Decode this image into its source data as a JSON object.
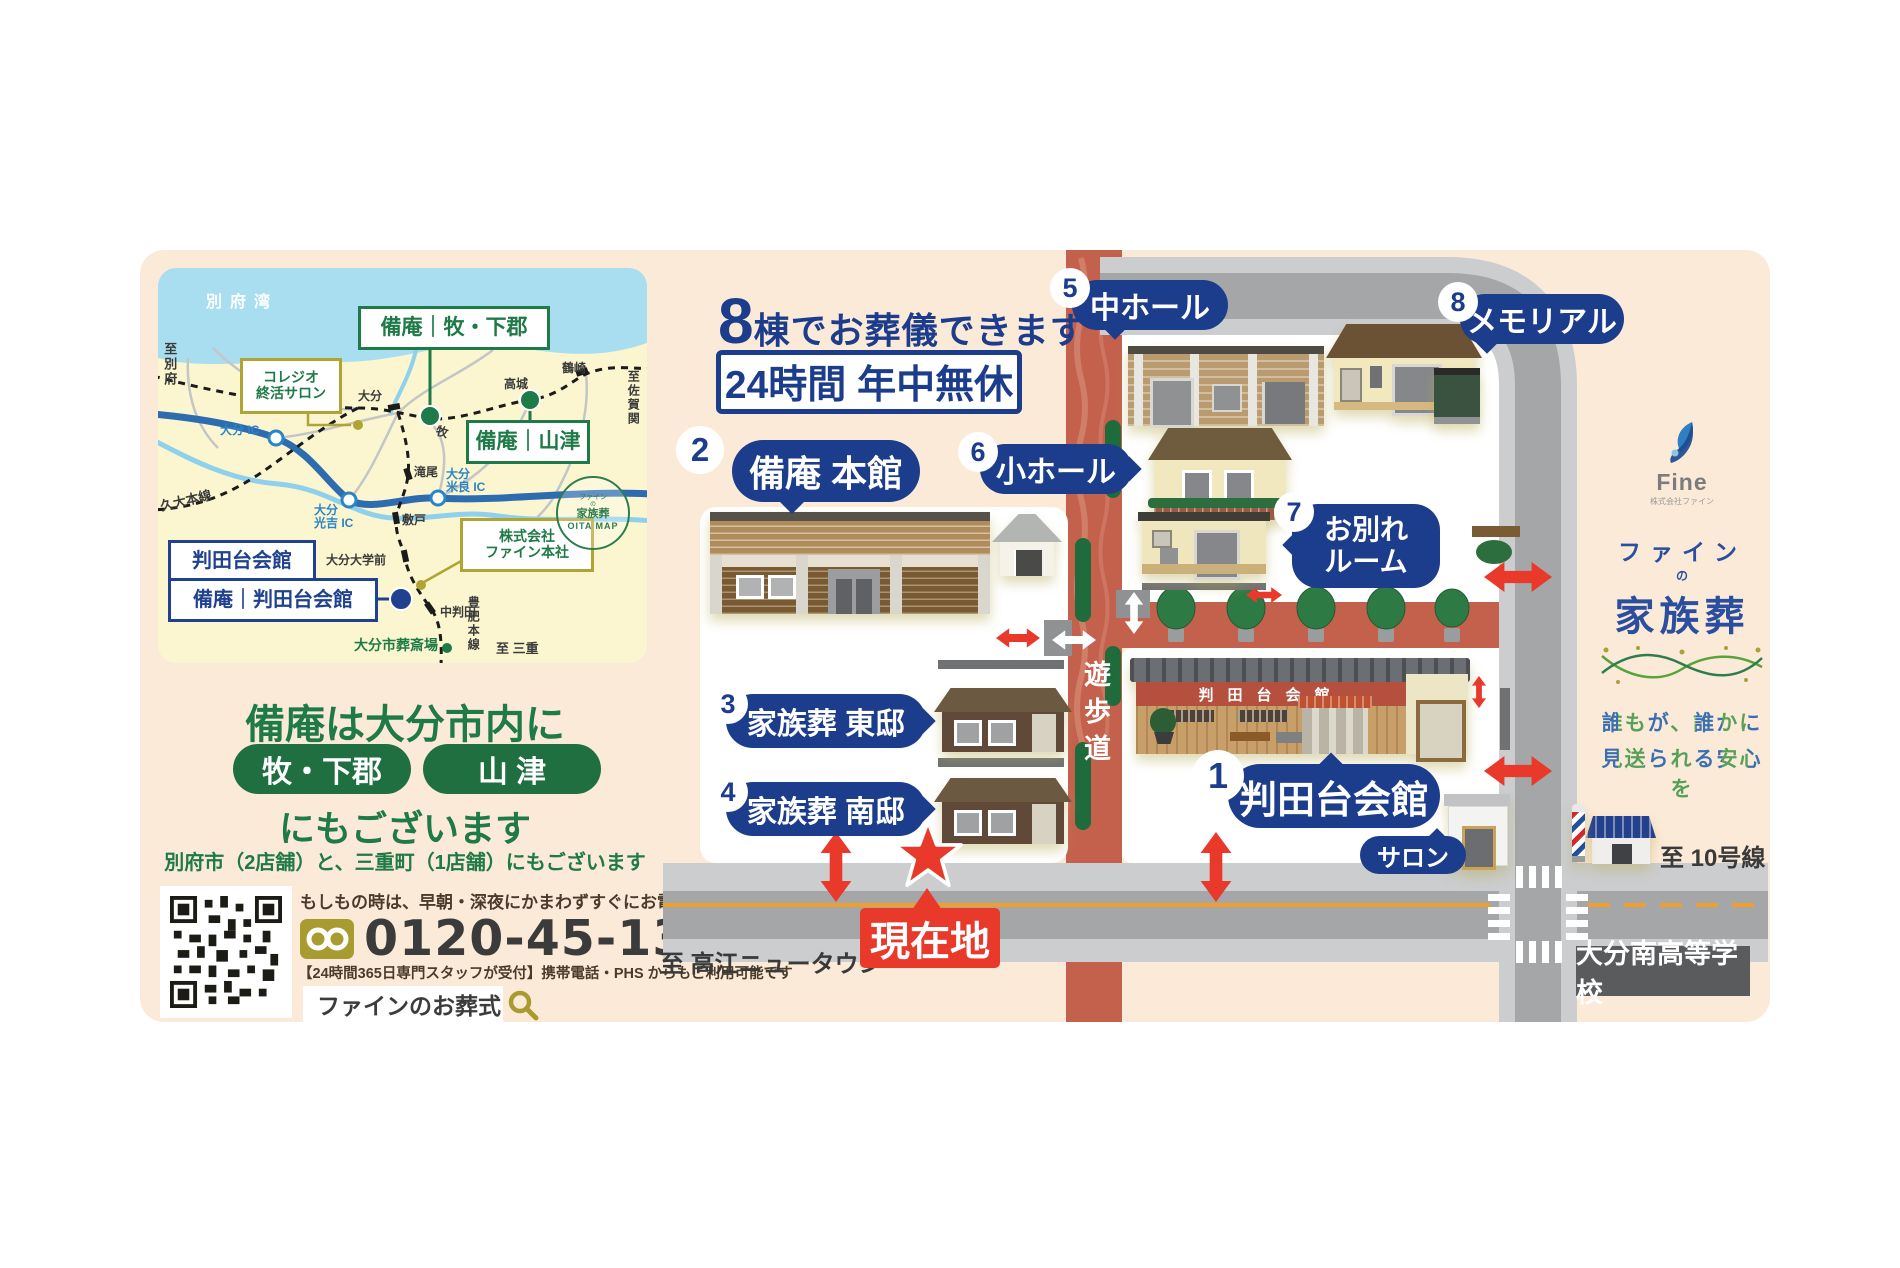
{
  "mini_map": {
    "sea": "別府湾",
    "to_beppu": "至別府",
    "to_saganoseki": "至佐賀関",
    "to_mie": "至 三重",
    "kudai_line": "久大本線",
    "hohi_line": "豊肥本線",
    "crematory": "大分市葬斎場",
    "stations": {
      "oita": "大分",
      "maki": "牧",
      "takajo": "高城",
      "tsurusaki": "鶴崎",
      "takio": "滝尾",
      "shikido": "敷戸",
      "daigakumae": "大分大学前",
      "nakahanda": "中判田"
    },
    "ics": {
      "oita": "大分 IC",
      "mitsuyoshi_1": "大分",
      "mitsuyoshi_2": "光吉 IC",
      "mera_1": "大分",
      "mera_2": "米良 IC"
    },
    "boxes": {
      "collegio_1": "コレジオ",
      "collegio_2": "終活サロン",
      "maki_shimogori": "備庵｜牧・下郡",
      "yamazu": "備庵｜山津",
      "fine_hq_1": "株式会社",
      "fine_hq_2": "ファイン本社",
      "handadai": "判田台会館",
      "bian_handadai": "備庵｜判田台会館"
    },
    "badge_logo_1": "ファイン",
    "badge_logo_2": "の",
    "badge_logo_3": "家族葬",
    "badge_text": "OITA MAP"
  },
  "left_info": {
    "headline1": "備庵は大分市内に",
    "pill1": "牧・下郡",
    "pill2": "山 津",
    "headline2": "にもございます",
    "note": "別府市（2店舗）と、三重町（1店舗）にもございます",
    "call_note": "もしもの時は、早朝・深夜にかまわずすぐにお電話下さい",
    "phone": "0120-45-1357",
    "phone_sub": "【24時間365日専門スタッフが受付】携帯電話・PHS からもご利用可能です",
    "search_text": "ファインのお葬式"
  },
  "main_map": {
    "headline_num": "8",
    "headline_text": "棟でお葬儀できます",
    "hours": "24時間 年中無休",
    "locations": [
      {
        "num": "1",
        "label": "判田台会館"
      },
      {
        "num": "2",
        "label": "備庵 本館"
      },
      {
        "num": "3",
        "label": "家族葬 東邸"
      },
      {
        "num": "4",
        "label": "家族葬 南邸"
      },
      {
        "num": "5",
        "label": "中ホール"
      },
      {
        "num": "6",
        "label": "小ホール"
      },
      {
        "num": "7",
        "label": "お別れルーム",
        "line1": "お別れ",
        "line2": "ルーム"
      },
      {
        "num": "8",
        "label": "メモリアル"
      }
    ],
    "salon": "サロン",
    "current": "現在地",
    "walkway": "遊歩道",
    "hall_sign": "判田台会館",
    "to_takae": "至 高江ニュータウン",
    "to_route10": "至 10号線",
    "school": "大分南高等学校"
  },
  "branding": {
    "fine": "Fine",
    "fine_sub": "株式会社ファイン",
    "logo_line1": "ファイン",
    "logo_no": "の",
    "logo_line2": "家族葬",
    "tagline1": "誰もが、誰かに",
    "tagline2": "見送られる安心を"
  },
  "colors": {
    "panel_bg": "#fcead9",
    "navy": "#1c3c8c",
    "green": "#1e7a46",
    "olive": "#b0a435",
    "red": "#e8392b",
    "walkway": "#c4614d",
    "road": "#a4a6a8",
    "sidewalk": "#cbcdcf",
    "orange_line": "#f09f2e"
  }
}
